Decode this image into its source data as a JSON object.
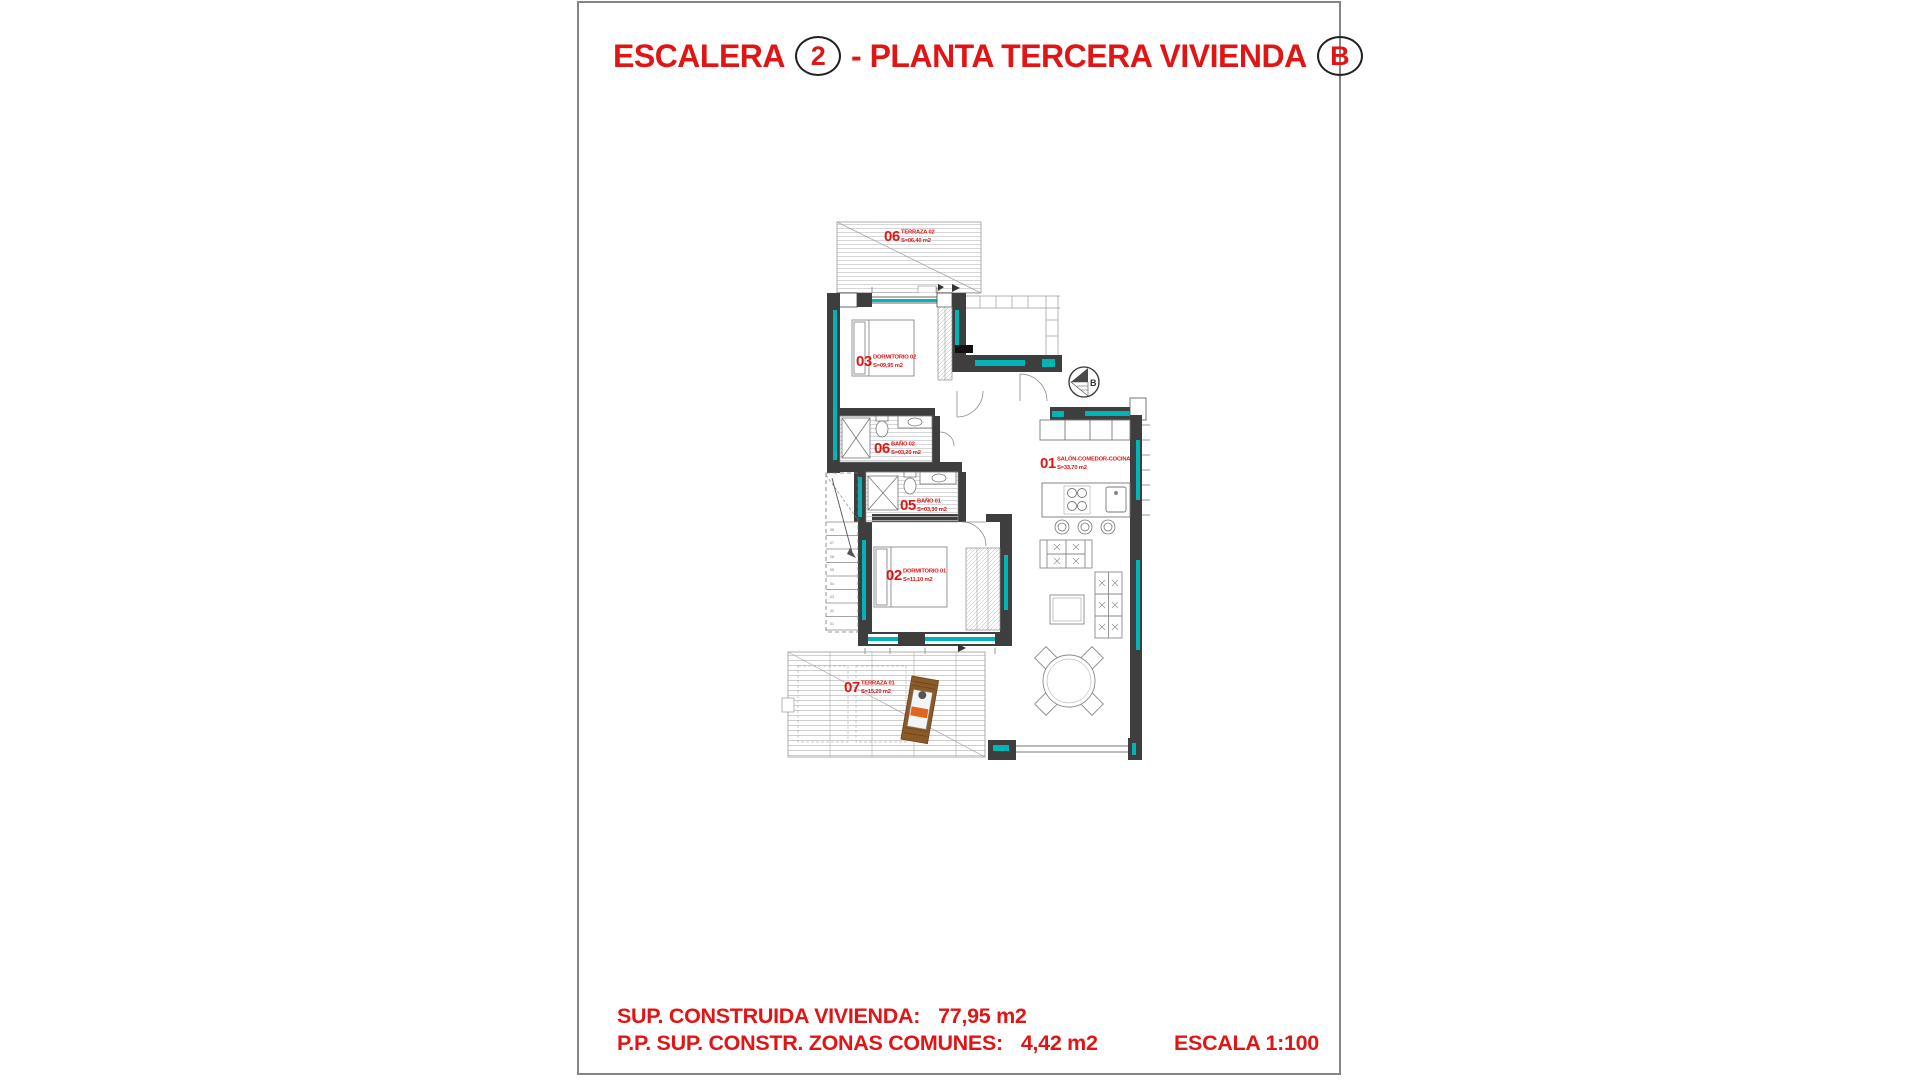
{
  "title": {
    "word1": "ESCALERA",
    "circle1": "2",
    "word2": "- PLANTA TERCERA VIVIENDA",
    "circle2": "B"
  },
  "footer": {
    "built_label": "SUP. CONSTRUIDA VIVIENDA:",
    "built_value": "77,95 m2",
    "common_label": "P.P. SUP. CONSTR. ZONAS COMUNES:",
    "common_value": "4,42 m2",
    "scale": "ESCALA 1:100"
  },
  "plan": {
    "entry_marker": "B",
    "rooms": [
      {
        "number": "06",
        "name": "TERRAZA 02",
        "area": "S=06,40 m2"
      },
      {
        "number": "03",
        "name": "DORMITORIO 02",
        "area": "S=09,95 m2"
      },
      {
        "number": "06",
        "name": "BAÑO 02",
        "area": "S=03,20 m2"
      },
      {
        "number": "05",
        "name": "BAÑO 01",
        "area": "S=03,30 m2"
      },
      {
        "number": "02",
        "name": "DORMITORIO 01",
        "area": "S=11,10 m2"
      },
      {
        "number": "07",
        "name": "TERRAZA 01",
        "area": "S=15,20 m2"
      },
      {
        "number": "01",
        "name": "SALÓN-COMEDOR-COCINA",
        "area": "S=33,70 m2"
      }
    ],
    "stairs_steps": [
      "08",
      "07",
      "06",
      "05",
      "04",
      "03",
      "02",
      "01"
    ],
    "colors": {
      "label_red": "#e01515",
      "wall_dark": "#3e3e3e",
      "insulation_teal": "#00b4b8",
      "hatch_gray": "#c9c9c9",
      "line_gray": "#8a8a8a",
      "lounger_brown": "#8a5a28",
      "lounger_orange": "#e2641e"
    }
  }
}
